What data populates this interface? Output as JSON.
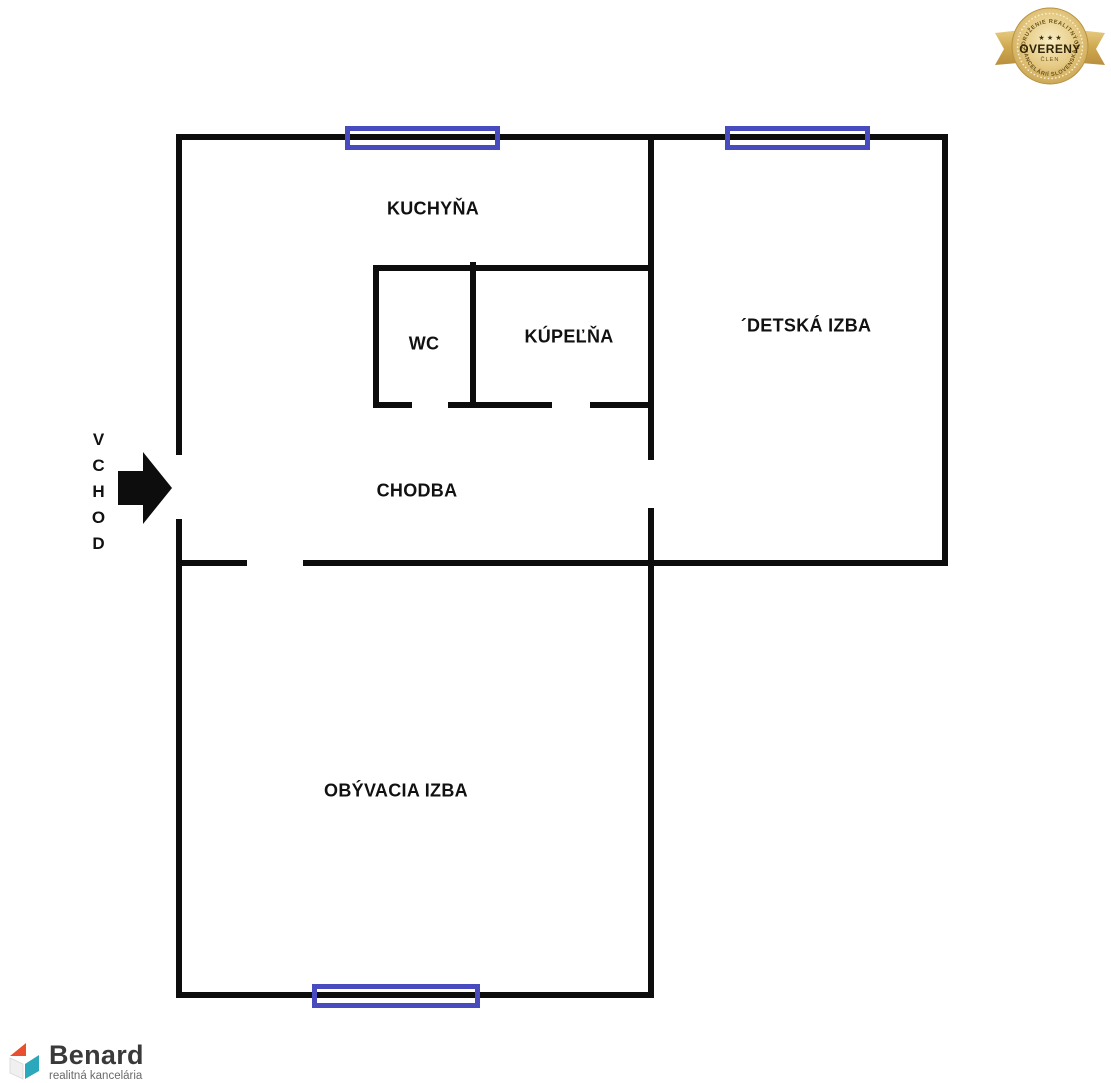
{
  "floorplan": {
    "rooms": {
      "kitchen": "KUCHYŇA",
      "wc": "WC",
      "bathroom": "KÚPEĽŇA",
      "kids_room": "´DETSKÁ IZBA",
      "hallway": "CHODBA",
      "living_room": "OBÝVACIA IZBA"
    },
    "entrance_label": "VCHOD"
  },
  "badge": {
    "arc_top": "ZDRUŽENIE REALITNÝCH",
    "arc_bottom": "KANCELÁRIÍ SLOVENSKA",
    "stars": "★ ★ ★",
    "title": "OVERENÝ",
    "subtitle": "ČLEN"
  },
  "logo": {
    "name": "Benard",
    "tagline": "realitná kancelária"
  },
  "colors": {
    "wall": "#0d0d0d",
    "window_frame": "#474bbd",
    "badge_gold": "#d9b561",
    "logo_orange": "#e8502f",
    "logo_teal": "#2ba8bc"
  }
}
